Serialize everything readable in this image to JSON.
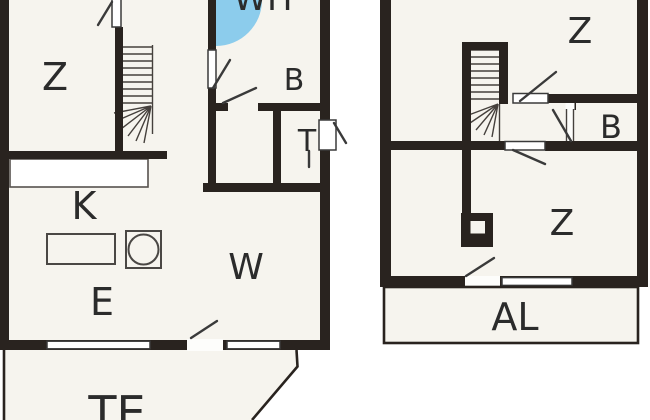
{
  "title": "Two-unit floor plan",
  "colors": {
    "wall": "#29231f",
    "line": "#3a3a3a",
    "room_fill": "#f6f4ee",
    "outside": "#ffffff",
    "shower_blue": "#8cccec",
    "text": "#2b2b2b"
  },
  "labels": {
    "left_z": "Z",
    "wh": "WH",
    "left_b": "B",
    "left_t": "T",
    "k": "K",
    "w": "W",
    "e": "E",
    "te": "TE",
    "right_z_top": "Z",
    "right_b": "B",
    "right_z_bottom": "Z",
    "al": "AL"
  },
  "symbols": {
    "shower": "corner-shower-quarter-circle",
    "stairs_left": "winder-staircase",
    "stairs_right": "winder-staircase",
    "kitchen_counter": "counter-rectangle",
    "kitchen_sink": "square-with-round-basin",
    "dining_table": "rectangle-table",
    "chimney": "hollow-square-block",
    "terrace": "open-outline",
    "balcony": "open-outline"
  }
}
